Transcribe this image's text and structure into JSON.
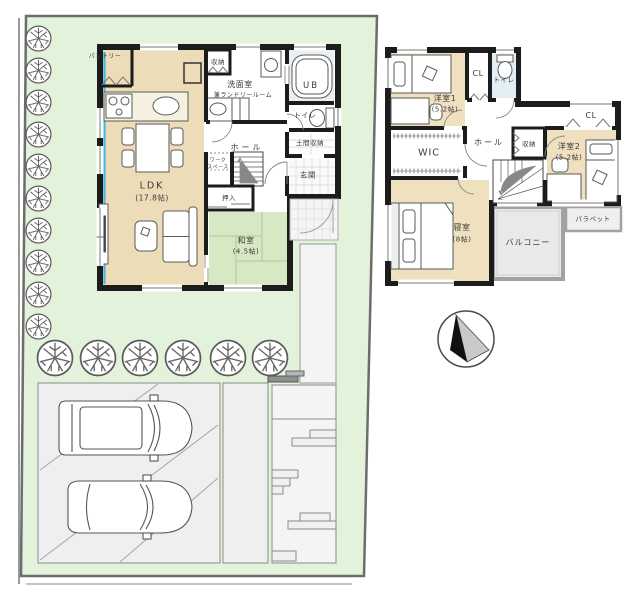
{
  "floor1": {
    "labels": {
      "pantry": "パントリー",
      "closet": "収納",
      "washroom_line1": "洗面室",
      "washroom_line2": "兼ランドリールーム",
      "bath": "UB",
      "toilet": "トイレ",
      "doma_storage": "土間収納",
      "hall": "ホール",
      "entrance": "玄関",
      "workspace_line1": "ワーク",
      "workspace_line2": "スペース",
      "oshiire": "押入",
      "japanese_room_line1": "和室",
      "japanese_room_line2": "(4.5帖)",
      "ldk_line1": "LDK",
      "ldk_line2": "(17.8帖)"
    }
  },
  "floor2": {
    "labels": {
      "bedroom1_line1": "洋室1",
      "bedroom1_line2": "(5.2帖)",
      "closet1": "CL",
      "toilet": "トイレ",
      "wic": "WIC",
      "hall": "ホール",
      "storage": "収納",
      "closet2": "CL",
      "bedroom2_line1": "洋室2",
      "bedroom2_line2": "(5.2帖)",
      "master_line1": "寝室",
      "master_line2": "(8帖)",
      "balcony": "バルコニー",
      "parapet": "パラペット"
    }
  },
  "colors": {
    "lawn": "#e3f2da",
    "tatami": "#d6e9c4",
    "wood_floor": "#eddcb8",
    "accent_cyan": "#3fb9e6",
    "balcony_gray": "#e9e9e9",
    "wall_black": "#1c1c1c"
  }
}
